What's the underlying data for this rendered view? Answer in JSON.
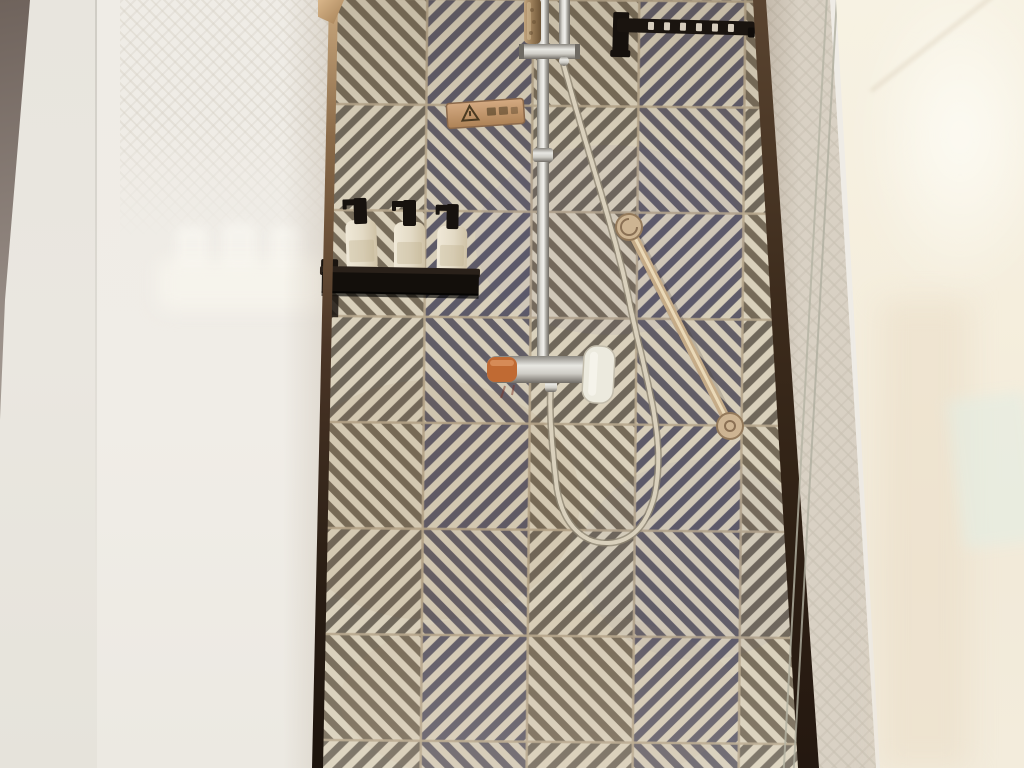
{
  "scene": {
    "type": "photograph",
    "label": "Hotel bathroom walk-in shower with geometric patterned tile feature wall",
    "tile_pattern": "interlocking diagonal-stripe tiles forming concentric diamond motifs",
    "tile_grid": {
      "columns": 4,
      "rows": 7,
      "tile_size_px": 106
    }
  },
  "palette": {
    "tile_cream": "#d8cfba",
    "tile_navy": "#5d5a68",
    "tile_tan": "#756a58",
    "grout": "#b7a88d",
    "frame_bronze_light": "#c9a87e",
    "frame_bronze_dark": "#241810",
    "left_wall": "#e8e5de",
    "frosted_panel": "#efece6",
    "wallpaper_strip": "#d9d1c4",
    "right_glass": "#f5eedd",
    "chrome": "#d8d6d0",
    "brass_grab_bar": "#c5ab87",
    "shelf_black": "#130f0b",
    "bottle_cream": "#e7dfcc",
    "sign_copper": "#c89d7e",
    "hose": "#d9d0bc",
    "mixer_accent_orange": "#c06a33",
    "hand_shower_bronze": "#a98f6f"
  },
  "objects": {
    "tile_wall": {
      "label": "Patterned shower feature wall"
    },
    "left_frame": {
      "label": "Bronze trim framing tile wall, left edge"
    },
    "right_frame": {
      "label": "Bronze trim framing tile wall, right edge"
    },
    "towel_rail": {
      "label": "Black towel hook rail",
      "hook_count": 6
    },
    "caution_sign": {
      "label": "Copper caution plaque with warning triangle",
      "icon": "warning-triangle",
      "text_legible": false
    },
    "shower_riser": {
      "label": "Chrome shower riser pipe"
    },
    "hand_shower": {
      "label": "Bronze hand shower docked in top bracket"
    },
    "shower_hose": {
      "label": "Flexible shower hose hanging in a long loop"
    },
    "mixer": {
      "label": "Chrome shower mixer bar",
      "accent": "orange end cap",
      "handle": "white paddle handle"
    },
    "grab_bar": {
      "label": "Brass diagonal grab bar with round flanges"
    },
    "amenities": {
      "shelf_label": "Black metal amenity shelf",
      "bottles": [
        {
          "label": "Amenity pump bottle 1"
        },
        {
          "label": "Amenity pump bottle 2"
        },
        {
          "label": "Amenity pump bottle 3"
        }
      ]
    },
    "frosted_panel": {
      "label": "Frosted panel with faint reflections of toiletries"
    },
    "right_glass": {
      "label": "Glossy glass panel with soft reflections"
    },
    "wallpaper": {
      "label": "Embossed geometric wallpaper strip"
    }
  }
}
